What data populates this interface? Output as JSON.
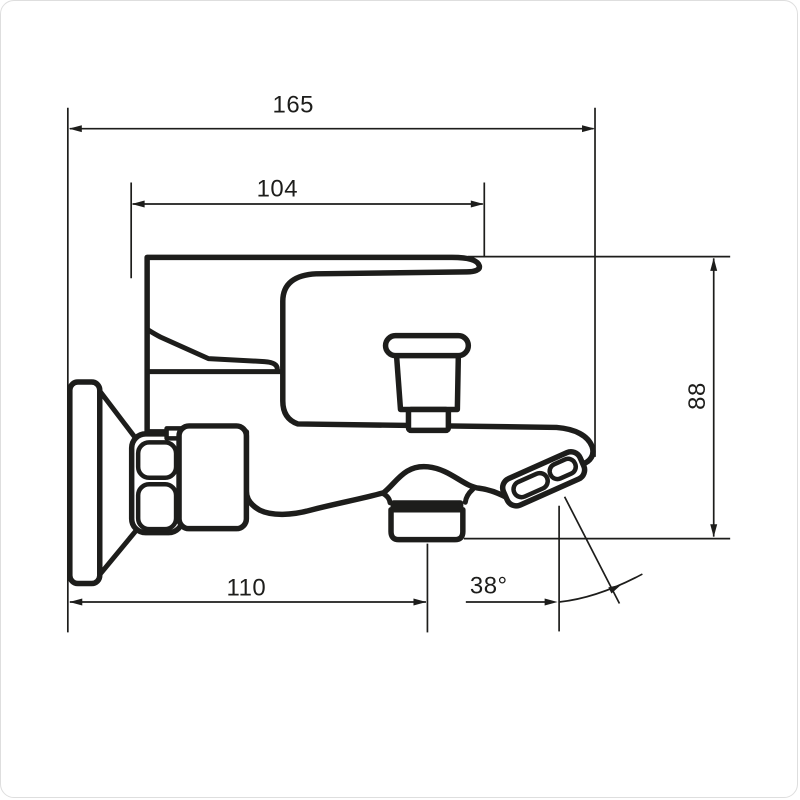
{
  "drawing": {
    "type": "technical-dimension-drawing",
    "subject": "wall-mounted bath shower mixer tap, side view",
    "line_color": "#1d1d1b",
    "background_color": "#ffffff",
    "dimensions": {
      "overall_depth": "165",
      "lever_length": "104",
      "body_height": "88",
      "outlet_distance": "110",
      "spout_angle": "38°"
    }
  }
}
